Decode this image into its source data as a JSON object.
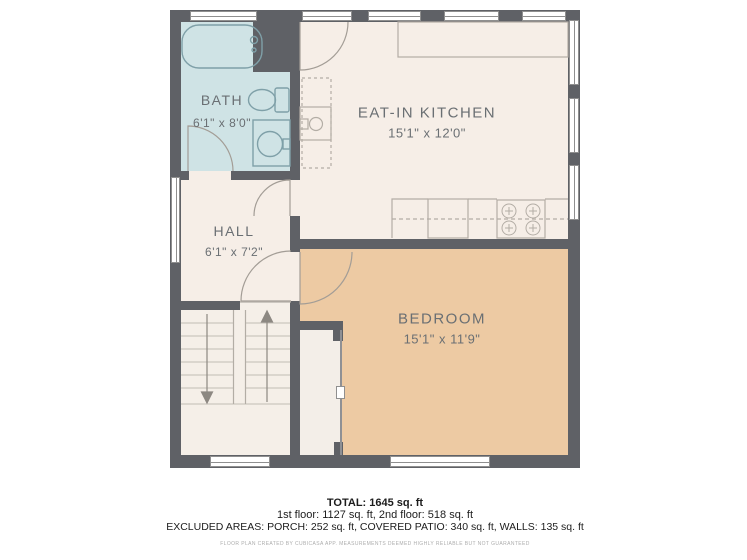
{
  "rooms": [
    {
      "id": "bath",
      "name": "BATH",
      "dims": "6'1\" x 8'0\""
    },
    {
      "id": "kitchen",
      "name": "EAT-IN KITCHEN",
      "dims": "15'1\" x 12'0\""
    },
    {
      "id": "hall",
      "name": "HALL",
      "dims": "6'1\" x 7'2\""
    },
    {
      "id": "bedroom",
      "name": "BEDROOM",
      "dims": "15'1\" x 11'9\""
    }
  ],
  "summary": {
    "total": "TOTAL: 1645 sq. ft",
    "floors": "1st floor: 1127 sq. ft, 2nd floor: 518 sq. ft",
    "excluded": "EXCLUDED AREAS: PORCH: 252 sq. ft, COVERED PATIO: 340 sq. ft, WALLS: 135 sq. ft"
  },
  "disclaimer": "FLOOR PLAN CREATED BY CUBICASA APP. MEASUREMENTS DEEMED HIGHLY RELIABLE BUT NOT GUARANTEED",
  "colors": {
    "wall": "#5f6166",
    "bath_floor": "#cfe3e5",
    "main_floor": "#f6eee7",
    "bedroom_floor": "#edcaa3"
  }
}
